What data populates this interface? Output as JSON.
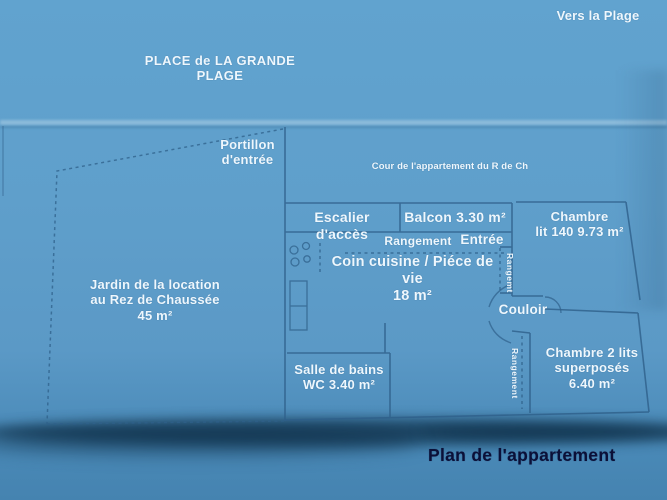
{
  "photo_caption": "Plan de l'appartement",
  "surroundings": {
    "vers_la_plage": "Vers la Plage",
    "place": "PLACE de LA GRANDE PLAGE",
    "portillon": "Portillon\nd'entrée",
    "cour": "Cour de l'appartement du R de Ch",
    "jardin": "Jardin de la location\nau Rez de Chaussée\n45 m²"
  },
  "rooms": {
    "escalier": "Escalier d'accès",
    "balcon": "Balcon 3.30 m²",
    "rangement_entree": "Rangement",
    "entree": "Entrée",
    "rangemt_chambre1": "Rangemt",
    "coin_cuisine": "Coin cuisine / Piéce de vie\n18 m²",
    "couloir": "Couloir",
    "chambre1": "Chambre\nlit 140 9.73 m²",
    "salle_de_bains": "Salle de bains\nWC  3.40 m²",
    "rangement_couloir": "Rangement",
    "chambre2": "Chambre 2 lits\nsuperposés\n6.40 m²"
  },
  "colors": {
    "background_blue": "#5f9fcb",
    "bottom_blue": "#4583b0",
    "wall_line": "#2f608a",
    "label_text": "#eef7fd",
    "title_text": "#0b1038",
    "shadow_band": "#092840"
  }
}
